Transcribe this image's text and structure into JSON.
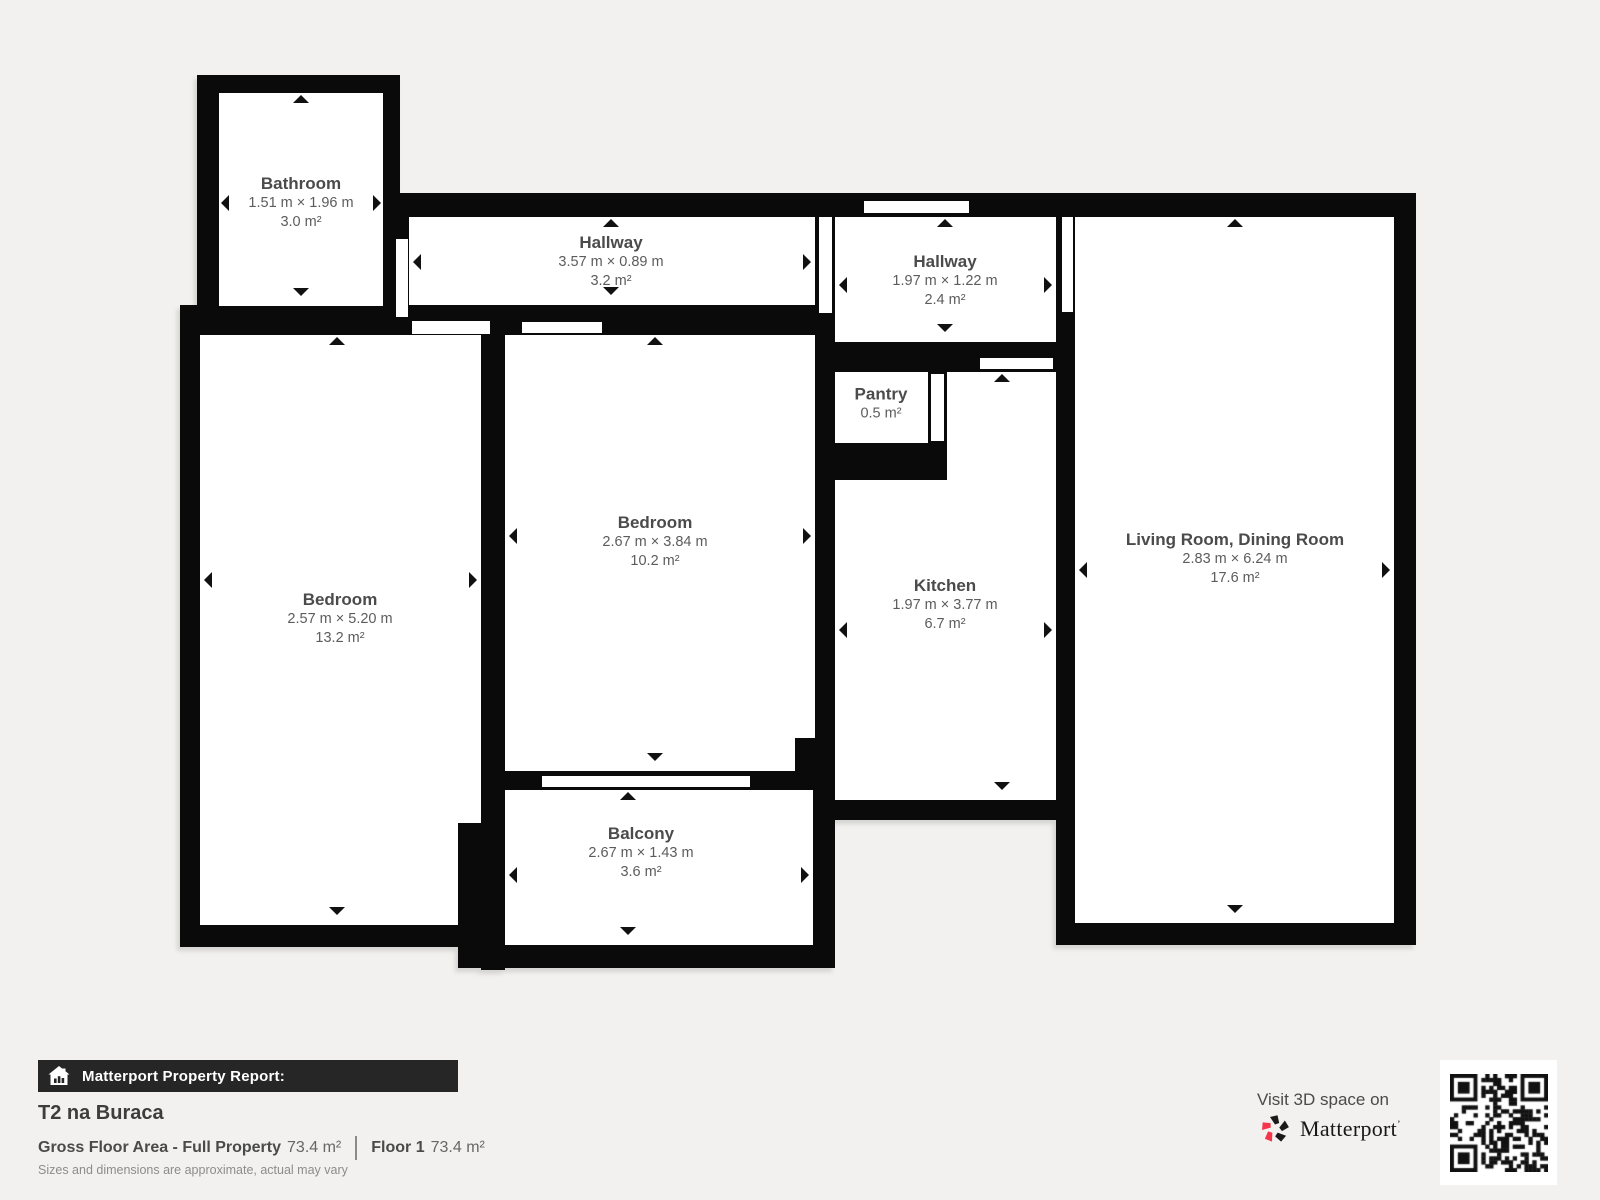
{
  "page": {
    "background": "#f2f1ef",
    "wall_color": "#0a0a0a",
    "accent_pink": "#f4364c"
  },
  "floorplan": {
    "walls": [
      [
        197,
        75,
        203,
        247
      ],
      [
        383,
        193,
        1033,
        24
      ],
      [
        383,
        193,
        26,
        142
      ],
      [
        180,
        305,
        655,
        30
      ],
      [
        180,
        305,
        20,
        642
      ],
      [
        481,
        305,
        24,
        665
      ],
      [
        180,
        925,
        325,
        22
      ],
      [
        815,
        193,
        20,
        627
      ],
      [
        813,
        773,
        22,
        195
      ],
      [
        483,
        771,
        352,
        19
      ],
      [
        815,
        800,
        260,
        20
      ],
      [
        458,
        945,
        377,
        23
      ],
      [
        815,
        342,
        243,
        30
      ],
      [
        928,
        342,
        19,
        138
      ],
      [
        815,
        443,
        132,
        37
      ],
      [
        1056,
        193,
        19,
        752
      ],
      [
        1056,
        923,
        360,
        22
      ],
      [
        1394,
        193,
        22,
        752
      ]
    ],
    "overlays": [
      [
        458,
        823,
        32,
        102
      ],
      [
        795,
        738,
        20,
        35
      ]
    ],
    "doors": [
      [
        396,
        239,
        12,
        78
      ],
      [
        412,
        321,
        78,
        13
      ],
      [
        522,
        322,
        80,
        11
      ],
      [
        819,
        217,
        13,
        96
      ],
      [
        864,
        201,
        105,
        12
      ],
      [
        1062,
        217,
        11,
        95
      ],
      [
        980,
        358,
        73,
        11
      ],
      [
        931,
        374,
        13,
        67
      ],
      [
        542,
        776,
        208,
        11
      ]
    ],
    "rooms": [
      {
        "name": "Bathroom",
        "dims": "1.51 m × 1.96 m",
        "area": "3.0 m²",
        "rects": [
          [
            219,
            93,
            164,
            213
          ]
        ],
        "label": [
          301,
          203
        ],
        "arrows": [
          [
            301,
            95,
            "up"
          ],
          [
            301,
            296,
            "down"
          ],
          [
            221,
            203,
            "left"
          ],
          [
            381,
            203,
            "right"
          ]
        ]
      },
      {
        "name": "Hallway",
        "dims": "3.57 m × 0.89 m",
        "area": "3.2 m²",
        "rects": [
          [
            409,
            217,
            406,
            88
          ]
        ],
        "label": [
          611,
          262
        ],
        "arrows": [
          [
            611,
            219,
            "up"
          ],
          [
            611,
            295,
            "down"
          ],
          [
            413,
            262,
            "left"
          ],
          [
            811,
            262,
            "right"
          ]
        ]
      },
      {
        "name": "Hallway",
        "dims": "1.97 m × 1.22 m",
        "area": "2.4 m²",
        "rects": [
          [
            835,
            217,
            221,
            125
          ]
        ],
        "label": [
          945,
          281
        ],
        "arrows": [
          [
            945,
            219,
            "up"
          ],
          [
            945,
            332,
            "down"
          ],
          [
            839,
            285,
            "left"
          ],
          [
            1052,
            285,
            "right"
          ]
        ]
      },
      {
        "name": "Pantry",
        "dims": "",
        "area": "0.5 m²",
        "rects": [
          [
            835,
            372,
            93,
            71
          ]
        ],
        "label": [
          881,
          404
        ],
        "arrows": []
      },
      {
        "name": "Bedroom",
        "dims": "2.67 m × 3.84 m",
        "area": "10.2 m²",
        "rects": [
          [
            505,
            335,
            310,
            436
          ]
        ],
        "label": [
          655,
          542
        ],
        "arrows": [
          [
            655,
            337,
            "up"
          ],
          [
            655,
            761,
            "down"
          ],
          [
            509,
            536,
            "left"
          ],
          [
            811,
            536,
            "right"
          ]
        ]
      },
      {
        "name": "Bedroom",
        "dims": "2.57 m × 5.20 m",
        "area": "13.2 m²",
        "rects": [
          [
            200,
            335,
            281,
            590
          ]
        ],
        "label": [
          340,
          619
        ],
        "arrows": [
          [
            337,
            337,
            "up"
          ],
          [
            337,
            915,
            "down"
          ],
          [
            204,
            580,
            "left"
          ],
          [
            477,
            580,
            "right"
          ]
        ]
      },
      {
        "name": "Kitchen",
        "dims": "1.97 m × 3.77 m",
        "area": "6.7 m²",
        "rects": [
          [
            947,
            372,
            109,
            108
          ],
          [
            835,
            480,
            221,
            320
          ]
        ],
        "label": [
          945,
          605
        ],
        "arrows": [
          [
            1002,
            374,
            "up"
          ],
          [
            1002,
            790,
            "down"
          ],
          [
            839,
            630,
            "left"
          ],
          [
            1052,
            630,
            "right"
          ]
        ]
      },
      {
        "name": "Living Room, Dining Room",
        "dims": "2.83 m × 6.24 m",
        "area": "17.6 m²",
        "rects": [
          [
            1075,
            217,
            319,
            706
          ]
        ],
        "label": [
          1235,
          559
        ],
        "arrows": [
          [
            1235,
            219,
            "up"
          ],
          [
            1235,
            913,
            "down"
          ],
          [
            1079,
            570,
            "left"
          ],
          [
            1390,
            570,
            "right"
          ]
        ]
      },
      {
        "name": "Balcony",
        "dims": "2.67 m × 1.43 m",
        "area": "3.6 m²",
        "rects": [
          [
            505,
            790,
            308,
            155
          ]
        ],
        "label": [
          641,
          853
        ],
        "arrows": [
          [
            628,
            792,
            "up"
          ],
          [
            628,
            935,
            "down"
          ],
          [
            509,
            875,
            "left"
          ],
          [
            809,
            875,
            "right"
          ]
        ]
      }
    ]
  },
  "footer": {
    "report_label": "Matterport Property Report:",
    "title": "T2 na Buraca",
    "gfa_label": "Gross Floor Area - Full Property",
    "gfa_value": "73.4 m²",
    "floor_label": "Floor 1",
    "floor_value": "73.4 m²",
    "disclaimer": "Sizes and dimensions are approximate, actual may vary",
    "visit_text": "Visit 3D space on",
    "brand": "Matterport",
    "brand_mark": "ʼ"
  }
}
